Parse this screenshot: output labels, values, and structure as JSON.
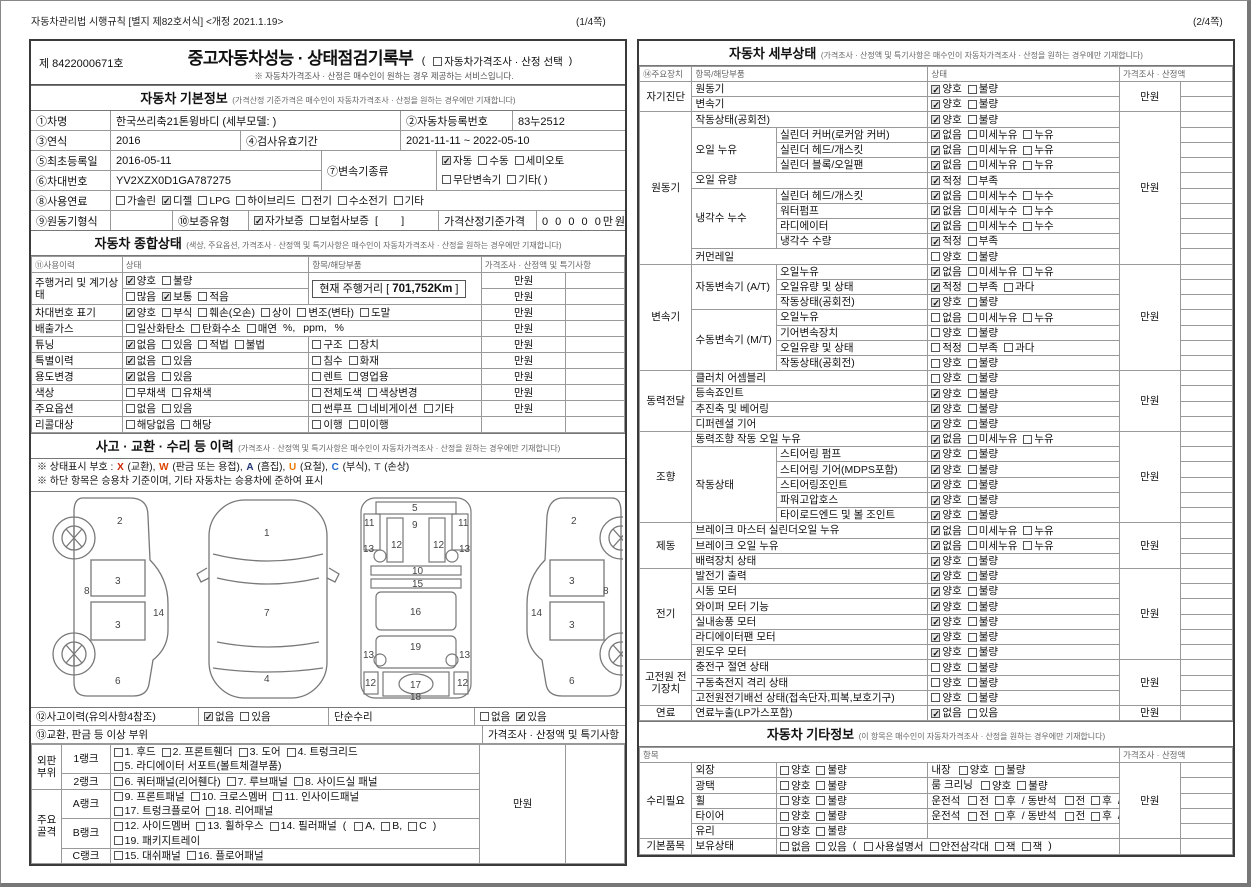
{
  "page1": {
    "meta": "자동차관리법 시행규칙 [별지 제82호서식] <개정 2021.1.19>",
    "page_no": "(1/4쪽)",
    "doc_no": "제 8422000671호",
    "title": "중고자동차성능 · 상태점검기록부",
    "title_opt": [
      "t:(",
      "c0:자동차가격조사 · 산정 선택",
      "t:)"
    ],
    "title_note": "※ 자동차가격조사 · 산정은 매수인이 원하는 경우 제공하는 서비스입니다.",
    "basic": {
      "title": "자동차 기본정보",
      "note": "(가격산정 기준가격은 매수인이 자동차가격조사 · 산정을 원하는 경우에만 기재합니다)",
      "f1": {
        "label": "①차명",
        "value": "한국쓰리축21톤윙바디 (세부모델: )",
        "label2": "②자동차등록번호",
        "value2": "83누2512"
      },
      "f2": {
        "label": "③연식",
        "value": "2016",
        "label2": "④검사유효기간",
        "value2": "2021-11-11 ~ 2022-05-10"
      },
      "f3": {
        "label": "⑤최초등록일",
        "value": "2016-05-11",
        "label_mid": "⑦변속기종류",
        "trans1": [
          "c1:자동",
          "c0:수동",
          "c0:세미오토"
        ],
        "trans2": [
          "c0:무단변속기",
          "c0:기타(      )"
        ]
      },
      "f4": {
        "label": "⑥차대번호",
        "value": "YV2XZX0D1GA787275"
      },
      "f5": {
        "label": "⑧사용연료",
        "segs": [
          "c0:가솔린",
          "c1:디젤",
          "c0:LPG",
          "c0:하이브리드",
          "c0:전기",
          "c0:수소전기",
          "c0:기타"
        ]
      },
      "f6": {
        "label": "⑨원동기형식",
        "label2": "⑩보증유형",
        "segs": [
          "c1:자가보증",
          "c0:보험사보증",
          "t:[        ]"
        ],
        "label3": "가격산정기준가격",
        "value3": "0 0 0 0 0만원"
      }
    },
    "status": {
      "title": "자동차 종합상태",
      "note": "(색상, 주요옵션, 가격조사 · 산정액 및 특기사항은 매수인이 자동차가격조사 · 산정을 원하는 경우에만 기재합니다)",
      "headers": [
        "⑪사용이력",
        "상태",
        "항목/해당부품",
        "가격조사 · 산정액 및 특기사항"
      ],
      "mileage_prefix": "현재 주행거리 [ ",
      "mileage_value": "701,752Km",
      "mileage_suffix": " ]",
      "rows": [
        {
          "label": "주행거리 및 계기상태",
          "labelRowspan": 2,
          "status": [
            "c1:양호",
            "c0:불량"
          ],
          "mileageBox": true,
          "partsRowspan": 2,
          "price": "만원"
        },
        {
          "status": [
            "c0:많음",
            "c1:보통",
            "c0:적음"
          ],
          "price": "만원"
        },
        {
          "label": "차대번호 표기",
          "merge": true,
          "status": [
            "c1:양호",
            "c0:부식",
            "c0:훼손(오손)",
            "c0:상이",
            "c0:변조(변타)",
            "c0:도말"
          ],
          "price": "만원"
        },
        {
          "label": "배출가스",
          "merge": true,
          "status": [
            "c0:일산화탄소",
            "c0:탄화수소",
            "c0:매연",
            "t:%,",
            "t:ppm,",
            "t:%"
          ],
          "price": "만원"
        },
        {
          "label": "튜닝",
          "status": [
            "c1:없음",
            "c0:있음",
            "c0:적법",
            "c0:불법"
          ],
          "parts": [
            "c0:구조",
            "c0:장치"
          ],
          "price": "만원"
        },
        {
          "label": "특별이력",
          "status": [
            "c1:없음",
            "c0:있음"
          ],
          "parts": [
            "c0:침수",
            "c0:화재"
          ],
          "price": "만원"
        },
        {
          "label": "용도변경",
          "status": [
            "c1:없음",
            "c0:있음"
          ],
          "parts": [
            "c0:렌트",
            "c0:영업용"
          ],
          "price": "만원"
        },
        {
          "label": "색상",
          "status": [
            "c0:무채색",
            "c0:유채색"
          ],
          "parts": [
            "c0:전체도색",
            "c0:색상변경"
          ],
          "price": "만원"
        },
        {
          "label": "주요옵션",
          "status": [
            "c0:없음",
            "c0:있음"
          ],
          "parts": [
            "c0:썬루프",
            "c0:네비게이션",
            "c0:기타"
          ],
          "price": "만원"
        },
        {
          "label": "리콜대상",
          "status": [
            "c0:해당없음",
            "c0:해당"
          ],
          "parts": [
            "c0:이행",
            "c0:미이행"
          ],
          "price": ""
        }
      ]
    },
    "accident": {
      "title": "사고 · 교환 · 수리 등 이력",
      "note": "(가격조사 · 산정액 및 특기사항은 매수인이 자동차가격조사 · 산정을 원하는 경우에만 기재합니다)",
      "codes_prefix": "※ 상태표시 부호 : ",
      "codes": [
        {
          "k": "X",
          "color": "#cc2200",
          "d": "(교환)"
        },
        {
          "k": "W",
          "color": "#dd4400",
          "d": "(판금 또는 용접)"
        },
        {
          "k": "A",
          "color": "#223377",
          "d": "(흠집)"
        },
        {
          "k": "U",
          "color": "#ee7700",
          "d": "(요철)"
        },
        {
          "k": "C",
          "color": "#2266cc",
          "d": "(부식)"
        },
        {
          "k": "T",
          "color": "#777777",
          "d": "(손상)"
        }
      ],
      "note2": "※ 하단 항목은 승용차 기준이며, 기타 자동차는 승용차에 준하여 표시",
      "row12_label": "⑫사고이력(유의사항4참조)",
      "row12_segs": [
        "c1:없음",
        "c0:있음"
      ],
      "row12_label2": "단순수리",
      "row12_segs2": [
        "c0:없음",
        "c1:있음"
      ],
      "row13_label": "⑬교환, 판금 등 이상 부위",
      "row13_right": "가격조사 · 산정액 및 특기사항"
    },
    "diagrams": {
      "side_left": [
        "2",
        "8",
        "3",
        "14",
        "3",
        "6"
      ],
      "top": [
        "1",
        "7",
        "4"
      ],
      "frame": [
        "5",
        "9",
        "11",
        "11",
        "13",
        "12",
        "12",
        "13",
        "10",
        "15",
        "16",
        "19",
        "13",
        "13",
        "12",
        "17",
        "12",
        "18"
      ],
      "side_right": [
        "2",
        "8",
        "3",
        "14",
        "3",
        "6"
      ]
    },
    "rank": {
      "price": "만원",
      "groups": [
        {
          "name": [
            "외판",
            "부위"
          ],
          "rows": [
            {
              "rank": "1랭크",
              "lines": [
                [
                  "c0:1. 후드",
                  "c0:2. 프론트휀더",
                  "c0:3. 도어",
                  "c0:4. 트렁크리드"
                ],
                [
                  "c0:5. 라디에이터 서포트(볼트체결부품)"
                ]
              ]
            },
            {
              "rank": "2랭크",
              "lines": [
                [
                  "c0:6. 쿼터패널(리어휀다)",
                  "c0:7. 루브패널",
                  "c0:8. 사이드실 패널"
                ]
              ]
            }
          ]
        },
        {
          "name": [
            "주요",
            "골격"
          ],
          "rows": [
            {
              "rank": "A랭크",
              "lines": [
                [
                  "c0:9. 프론트패널",
                  "c0:10. 크로스멤버",
                  "c0:11. 인사이드패널"
                ],
                [
                  "c0:17. 트렁크플로어",
                  "c0:18. 리어패널"
                ]
              ]
            },
            {
              "rank": "B랭크",
              "lines": [
                [
                  "c0:12. 사이드멤버",
                  "c0:13. 휠하우스",
                  "c0:14. 필러패널",
                  "t:(",
                  "c0:A,",
                  "c0:B,",
                  "c0:C",
                  "t:)"
                ],
                [
                  "c0:19. 패키지트레이"
                ]
              ]
            },
            {
              "rank": "C랭크",
              "lines": [
                [
                  "c0:15. 대쉬패널",
                  "c0:16. 플로어패널"
                ]
              ]
            }
          ]
        }
      ]
    }
  },
  "page2": {
    "page_no": "(2/4쪽)",
    "detail": {
      "title": "자동차 세부상태",
      "note": "(가격조사 · 산정액 및 특기사항은 매수인이 자동차가격조사 · 산정을 원하는 경우에만 기재합니다)",
      "headers": [
        "⑭주요장치",
        "항목/해당부품",
        "상태",
        "가격조사 · 산정액"
      ],
      "groups": [
        {
          "name": "자기진단",
          "price": "만원",
          "rows": [
            {
              "part": "원동기",
              "checks": [
                "c1:양호",
                "c0:불량"
              ]
            },
            {
              "part": "변속기",
              "checks": [
                "c1:양호",
                "c0:불량"
              ]
            }
          ]
        },
        {
          "name": "원동기",
          "price": "만원",
          "rows": [
            {
              "part": "작동상태(공회전)",
              "checks": [
                "c1:양호",
                "c0:불량"
              ]
            },
            {
              "sub": "오일 누유",
              "subspan": 3,
              "part": "실린더 커버(로커암 커버)",
              "checks": [
                "c1:없음",
                "c0:미세누유",
                "c0:누유"
              ]
            },
            {
              "part": "실린더 헤드/개스킷",
              "checks": [
                "c1:없음",
                "c0:미세누유",
                "c0:누유"
              ]
            },
            {
              "part": "실린더 블록/오일팬",
              "checks": [
                "c1:없음",
                "c0:미세누유",
                "c0:누유"
              ]
            },
            {
              "part": "오일 유량",
              "checks": [
                "c1:적정",
                "c0:부족"
              ]
            },
            {
              "sub": "냉각수 누수",
              "subspan": 4,
              "part": "실린더 헤드/개스킷",
              "checks": [
                "c1:없음",
                "c0:미세누수",
                "c0:누수"
              ]
            },
            {
              "part": "워터펌프",
              "checks": [
                "c1:없음",
                "c0:미세누수",
                "c0:누수"
              ]
            },
            {
              "part": "라디에이터",
              "checks": [
                "c1:없음",
                "c0:미세누수",
                "c0:누수"
              ]
            },
            {
              "part": "냉각수 수량",
              "checks": [
                "c1:적정",
                "c0:부족"
              ]
            },
            {
              "part": "커먼레일",
              "checks": [
                "c0:양호",
                "c0:불량"
              ]
            }
          ]
        },
        {
          "name": "변속기",
          "price": "만원",
          "rows": [
            {
              "sub": "자동변속기 (A/T)",
              "subspan": 3,
              "part": "오일누유",
              "checks": [
                "c1:없음",
                "c0:미세누유",
                "c0:누유"
              ]
            },
            {
              "part": "오일유량 및 상태",
              "checks": [
                "c1:적정",
                "c0:부족",
                "c0:과다"
              ]
            },
            {
              "part": "작동상태(공회전)",
              "checks": [
                "c1:양호",
                "c0:불량"
              ]
            },
            {
              "sub": "수동변속기 (M/T)",
              "subspan": 4,
              "part": "오일누유",
              "checks": [
                "c0:없음",
                "c0:미세누유",
                "c0:누유"
              ]
            },
            {
              "part": "기어변속장치",
              "checks": [
                "c0:양호",
                "c0:불량"
              ]
            },
            {
              "part": "오일유량 및 상태",
              "checks": [
                "c0:적정",
                "c0:부족",
                "c0:과다"
              ]
            },
            {
              "part": "작동상태(공회전)",
              "checks": [
                "c0:양호",
                "c0:불량"
              ]
            }
          ]
        },
        {
          "name": "동력전달",
          "price": "만원",
          "rows": [
            {
              "part": "클러치 어셈블리",
              "checks": [
                "c0:양호",
                "c0:불량"
              ]
            },
            {
              "part": "등속죠인트",
              "checks": [
                "c1:양호",
                "c0:불량"
              ]
            },
            {
              "part": "추진축 및 베어링",
              "checks": [
                "c1:양호",
                "c0:불량"
              ]
            },
            {
              "part": "디퍼렌셜 기어",
              "checks": [
                "c1:양호",
                "c0:불량"
              ]
            }
          ]
        },
        {
          "name": "조향",
          "price": "만원",
          "rows": [
            {
              "part": "동력조향 작동 오일 누유",
              "checks": [
                "c1:없음",
                "c0:미세누유",
                "c0:누유"
              ]
            },
            {
              "sub": "작동상태",
              "subspan": 5,
              "part": "스티어링 펌프",
              "checks": [
                "c1:양호",
                "c0:불량"
              ]
            },
            {
              "part": "스티어링 기어(MDPS포함)",
              "checks": [
                "c1:양호",
                "c0:불량"
              ]
            },
            {
              "part": "스티어링조인트",
              "checks": [
                "c1:양호",
                "c0:불량"
              ]
            },
            {
              "part": "파워고압호스",
              "checks": [
                "c1:양호",
                "c0:불량"
              ]
            },
            {
              "part": "타이로드엔드 및 볼 조인트",
              "checks": [
                "c1:양호",
                "c0:불량"
              ]
            }
          ]
        },
        {
          "name": "제동",
          "price": "만원",
          "rows": [
            {
              "part": "브레이크 마스터 실린더오일 누유",
              "checks": [
                "c1:없음",
                "c0:미세누유",
                "c0:누유"
              ]
            },
            {
              "part": "브레이크 오일 누유",
              "checks": [
                "c1:없음",
                "c0:미세누유",
                "c0:누유"
              ]
            },
            {
              "part": "배력장치 상태",
              "checks": [
                "c1:양호",
                "c0:불량"
              ]
            }
          ]
        },
        {
          "name": "전기",
          "price": "만원",
          "rows": [
            {
              "part": "발전기 출력",
              "checks": [
                "c1:양호",
                "c0:불량"
              ]
            },
            {
              "part": "시동 모터",
              "checks": [
                "c1:양호",
                "c0:불량"
              ]
            },
            {
              "part": "와이퍼 모터 기능",
              "checks": [
                "c1:양호",
                "c0:불량"
              ]
            },
            {
              "part": "실내송풍 모터",
              "checks": [
                "c1:양호",
                "c0:불량"
              ]
            },
            {
              "part": "라디에이터팬 모터",
              "checks": [
                "c1:양호",
                "c0:불량"
              ]
            },
            {
              "part": "윈도우 모터",
              "checks": [
                "c1:양호",
                "c0:불량"
              ]
            }
          ]
        },
        {
          "name": "고전원 전기장치",
          "price": "만원",
          "rows": [
            {
              "part": "충전구 절연 상태",
              "checks": [
                "c0:양호",
                "c0:불량"
              ]
            },
            {
              "part": "구동축전지 격리 상태",
              "checks": [
                "c0:양호",
                "c0:불량"
              ]
            },
            {
              "part": "고전원전기배선 상태(접속단자,피복,보호기구)",
              "checks": [
                "c0:양호",
                "c0:불량"
              ]
            }
          ]
        },
        {
          "name": "연료",
          "price": "만원",
          "rows": [
            {
              "part": "연료누출(LP가스포함)",
              "checks": [
                "c1:없음",
                "c0:있음"
              ]
            }
          ]
        }
      ]
    },
    "misc": {
      "title": "자동차 기타정보",
      "note": "(이 항목은 매수인이 자동차가격조사 · 산정을 원하는 경우에만 기재합니다)",
      "headers": [
        "항목",
        "가격조사 · 산정액"
      ],
      "groups": [
        {
          "name": "수리필요",
          "price": "만원",
          "rows": [
            {
              "part": "외장",
              "checks": [
                "c0:양호",
                "c0:불량"
              ],
              "segs2": [
                "t:내장",
                "c0:양호",
                "c0:불량"
              ]
            },
            {
              "part": "광택",
              "checks": [
                "c0:양호",
                "c0:불량"
              ],
              "segs2": [
                "t:룸 크리닝",
                "c0:양호",
                "c0:불량"
              ]
            },
            {
              "part": "휠",
              "checks": [
                "c0:양호",
                "c0:불량"
              ],
              "segs2": [
                "t:운전석",
                "c0:전",
                "c0:후",
                "t:/ 동반석",
                "c0:전",
                "c0:후",
                "t:/",
                "c0:응급"
              ]
            },
            {
              "part": "타이어",
              "checks": [
                "c0:양호",
                "c0:불량"
              ],
              "segs2": [
                "t:운전석",
                "c0:전",
                "c0:후",
                "t:/ 동반석",
                "c0:전",
                "c0:후",
                "t:/",
                "c0:응급"
              ]
            },
            {
              "part": "유리",
              "checks": [
                "c0:양호",
                "c0:불량"
              ]
            }
          ]
        },
        {
          "name": "기본품목",
          "price": "",
          "rows": [
            {
              "part": "보유상태",
              "wide": [
                "c0:없음",
                "c0:있음",
                "t:(",
                "c0:사용설명서",
                "c0:안전삼각대",
                "c0:잭",
                "c0:잭",
                "t:)"
              ]
            }
          ]
        }
      ]
    }
  }
}
